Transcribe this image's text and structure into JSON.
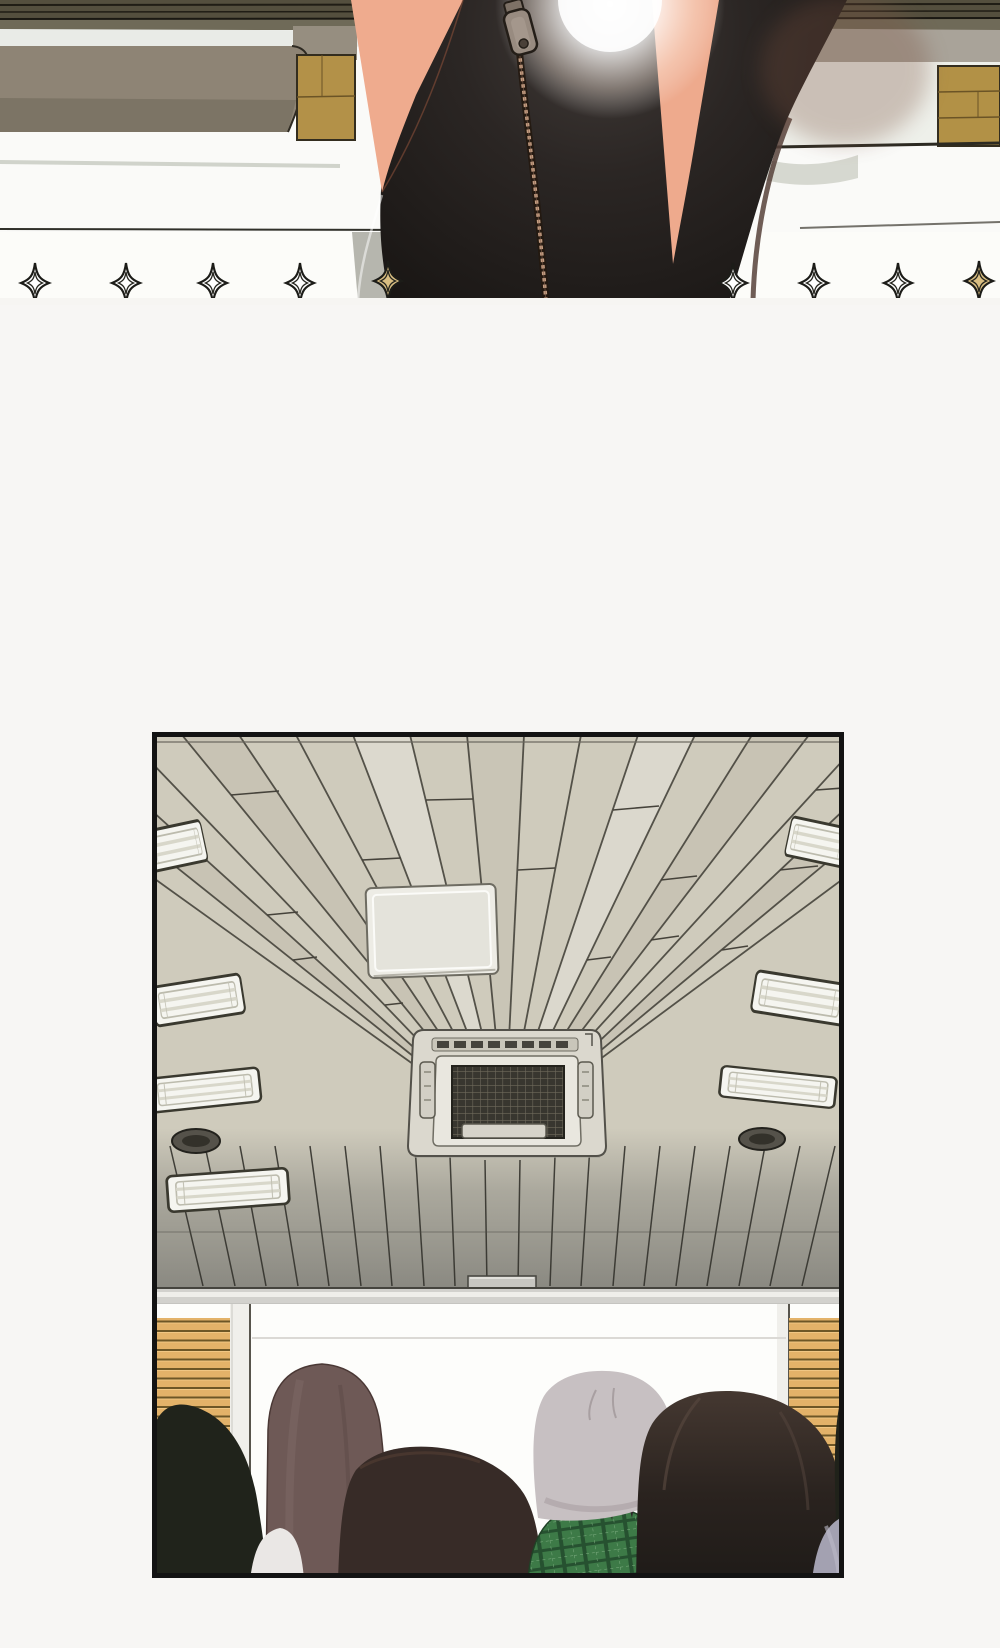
{
  "page": {
    "kind": "webtoon comic page",
    "panel_count": 2,
    "visible_text": "none"
  },
  "panel_1": {
    "alt": "Close-up from behind of a woman in a black zip-up pencil skirt standing between classroom desks; a bright glare shines at the top center and a row of four-pointed sparkle ornaments runs along the bottom edge of the panel.",
    "sparkle_count": 9,
    "sparkle_gold_positions": [
      5,
      9
    ]
  },
  "panel_2": {
    "alt": "View looking straight up at a wood-plank classroom ceiling with fluorescent light bars, two round speakers, a white ceiling access panel and a cassette air-conditioning unit; below, the backs of six audience members' heads face a blank whiteboard flanked by wooden slat walls."
  },
  "palette": {
    "page_background": "#f7f6f4",
    "panel_border": "#131313",
    "skin": "#efab8e",
    "skirt_black": "#171412",
    "zipper_teeth": "#c49e83",
    "desk_gray": "#8e8475",
    "wood_tan": "#b29146",
    "band_white": "#eef0ea",
    "ceiling_plank": "#cfcbbc",
    "ceiling_dark_zone": "#8c8b85",
    "wall_band": "#d2d1cd",
    "wall_slat": "#e3b269",
    "whiteboard": "#fdfdfb",
    "light_fixture": "#f5f5f0",
    "speaker_dark": "#55524a",
    "hair_silver": "#c7c0c2",
    "hair_mauve": "#6e5956",
    "hair_dark_brown": "#372b27",
    "hair_black_green": "#20231b",
    "shirt_green_plaid": "#3d7a47",
    "shirt_lavender": "#a3a1b1",
    "collar_white": "#eae7e5",
    "sparkle_gold": "#d9be82"
  }
}
